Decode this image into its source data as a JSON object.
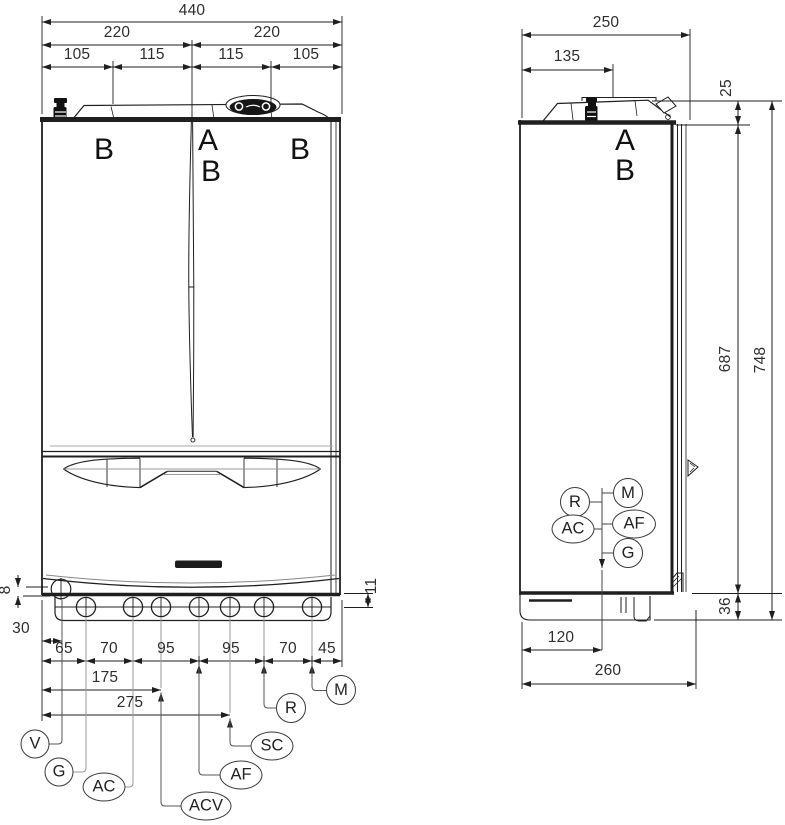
{
  "front": {
    "width_total": "440",
    "width_halves": [
      "220",
      "220"
    ],
    "width_quarters": [
      "105",
      "115",
      "115",
      "105"
    ],
    "label_b_left": "B",
    "label_a": "A",
    "label_b_center": "B",
    "label_b_right": "B",
    "lip_height": "8",
    "offset_first": "30",
    "edge_drop": "11",
    "chain": [
      "65",
      "70",
      "95",
      "95",
      "70",
      "45"
    ],
    "dim_175": "175",
    "dim_275": "275",
    "tags": {
      "v": "V",
      "g": "G",
      "ac": "AC",
      "acv": "ACV",
      "af": "AF",
      "sc": "SC",
      "r": "R",
      "m": "M"
    }
  },
  "side": {
    "depth_total": "250",
    "flue_offset": "135",
    "cap_height": "25",
    "body_height": "687",
    "total_height": "748",
    "base_height": "36",
    "conn_offset": "120",
    "base_depth": "260",
    "label_a": "A",
    "label_b": "B",
    "tags": {
      "r": "R",
      "m": "M",
      "ac": "AC",
      "af": "AF",
      "g": "G"
    }
  },
  "colors": {
    "line": "#1f1f1f",
    "thin_line": "#999999",
    "text": "#2e2e2e"
  }
}
